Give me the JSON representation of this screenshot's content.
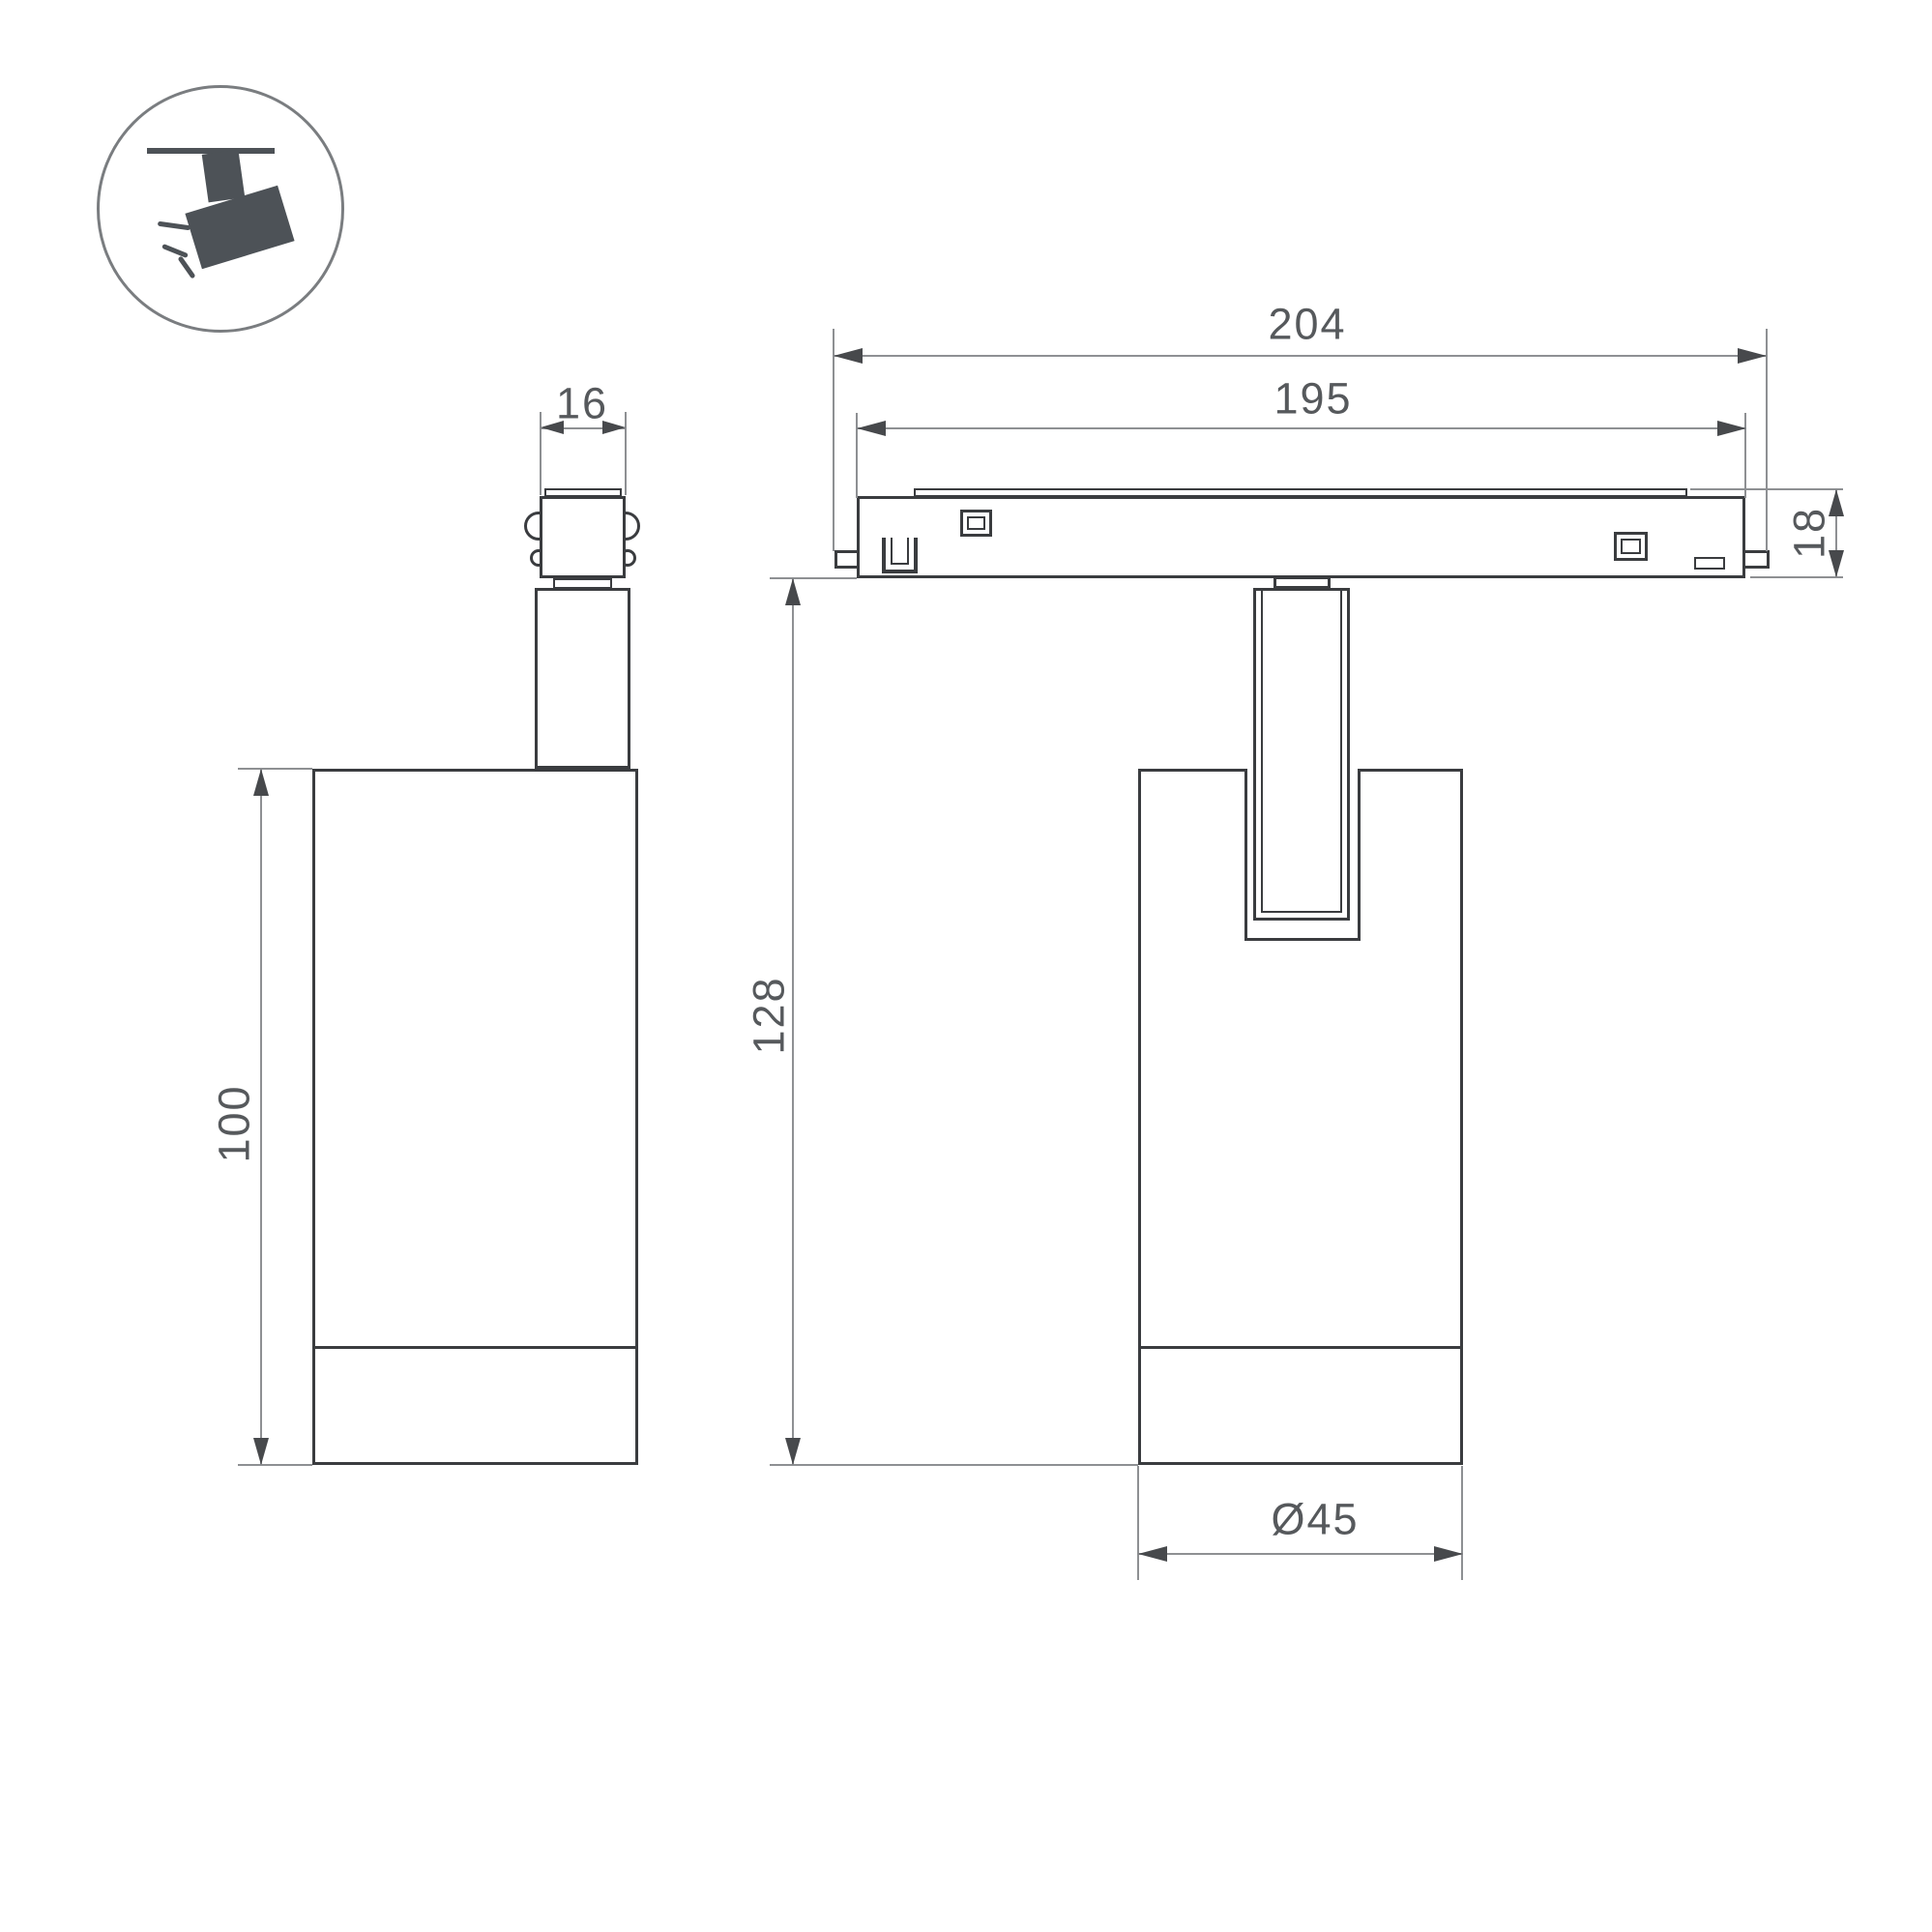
{
  "drawing": {
    "title": "track spotlight dimensional drawing",
    "icon": {
      "name": "ceiling-track-spotlight"
    },
    "views": {
      "side_view": {
        "name": "side view of spotlight"
      },
      "front_view": {
        "name": "front view of spotlight on track rail"
      }
    },
    "dim_labels": {
      "connector_width": "16",
      "overall_length": "204",
      "rail_length": "195",
      "rail_height": "18",
      "total_height": "128",
      "body_height": "100",
      "body_diameter": "Ø45"
    }
  },
  "colors": {
    "outline": "#3a3c3f",
    "dim": "#8e9093",
    "arrow": "#47494c",
    "text": "#56595c",
    "icon": "#4d5257",
    "circle": "#7a7d80",
    "bg": "#ffffff"
  }
}
